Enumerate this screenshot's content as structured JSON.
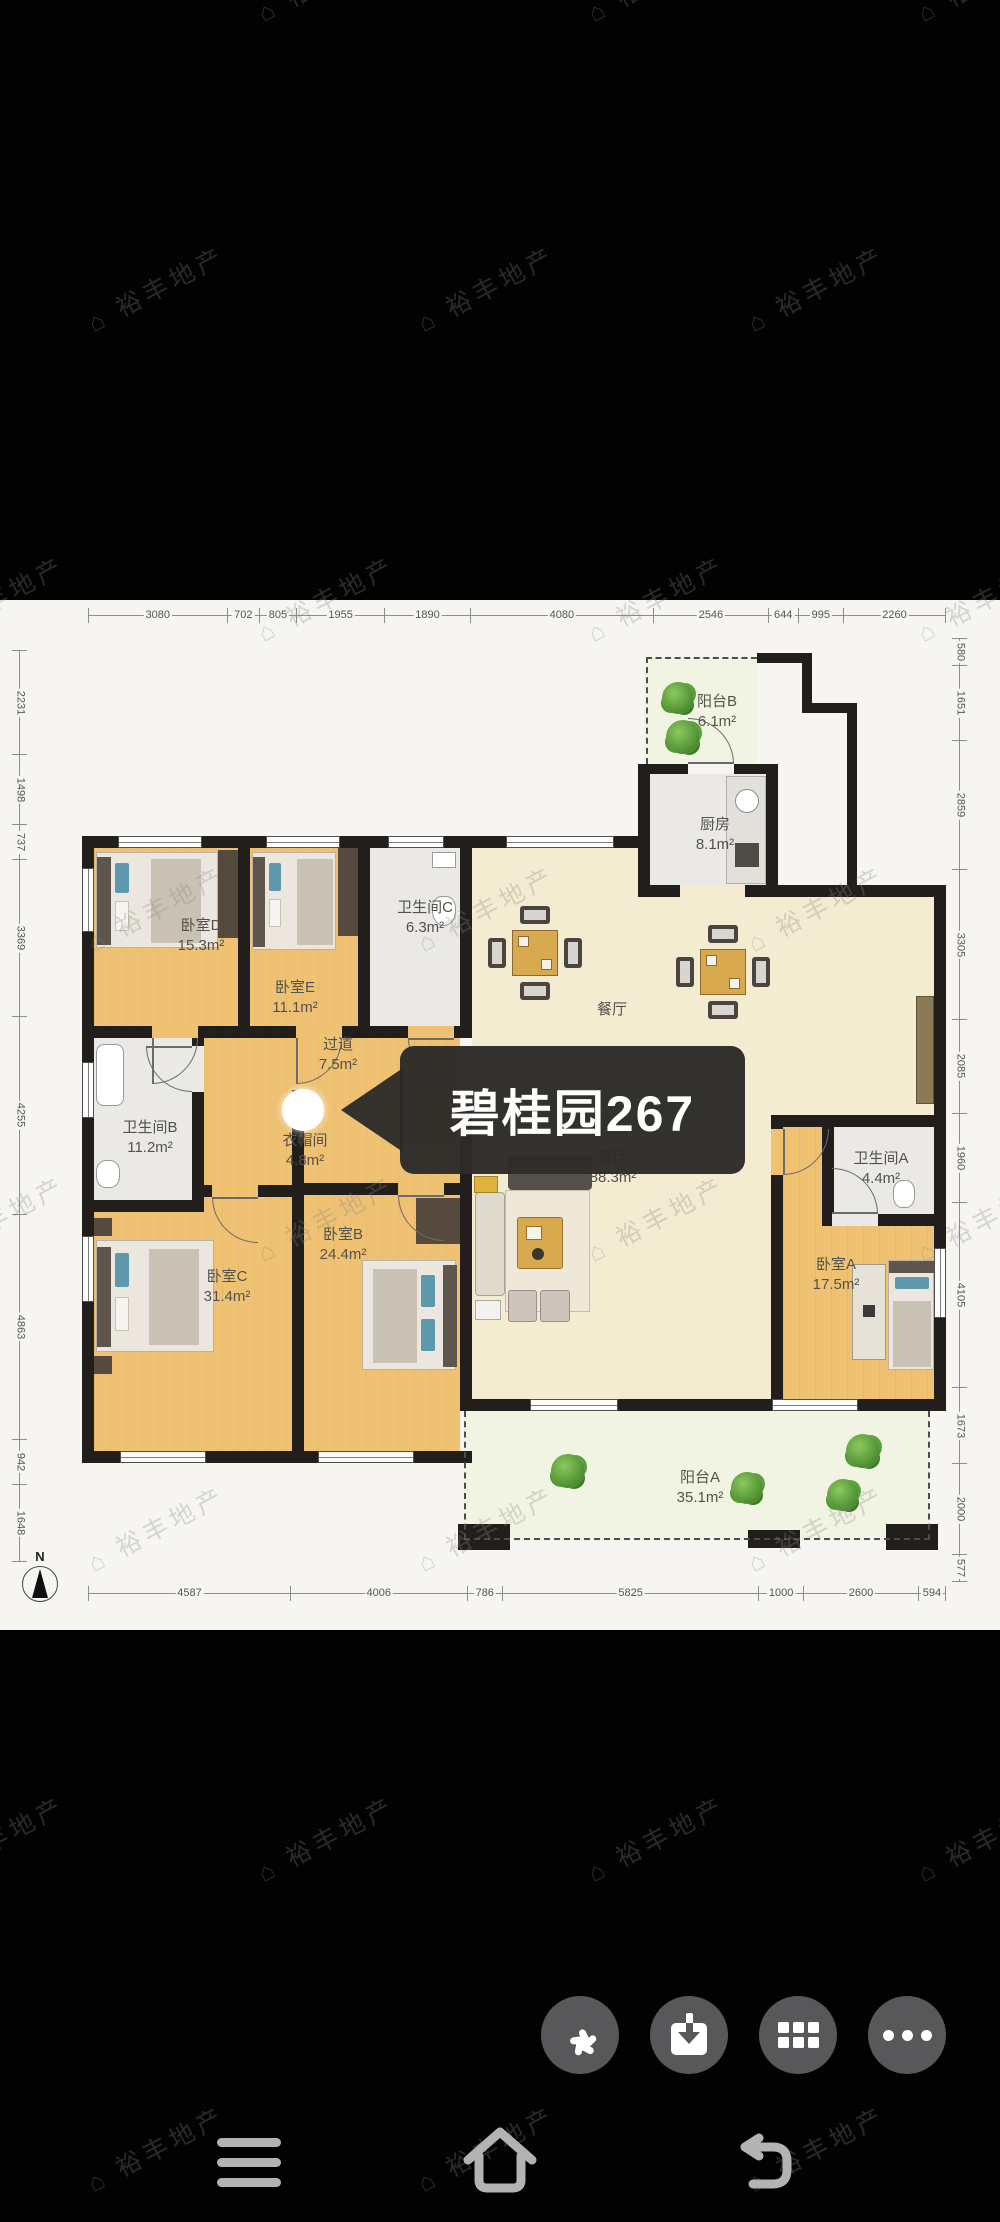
{
  "floorplan": {
    "overlay_title": "碧桂园267",
    "compass_label": "N",
    "rooms": {
      "bedroomD": {
        "name": "卧室D",
        "area": "15.3m²"
      },
      "bedroomE": {
        "name": "卧室E",
        "area": "11.1m²"
      },
      "bathC": {
        "name": "卫生间C",
        "area": "6.3m²"
      },
      "balconyB": {
        "name": "阳台B",
        "area": "6.1m²"
      },
      "kitchen": {
        "name": "厨房",
        "area": "8.1m²"
      },
      "dining": {
        "name": "餐厅"
      },
      "hallway": {
        "name": "过道",
        "area": "7.5m²"
      },
      "bathB": {
        "name": "卫生间B",
        "area": "11.2m²"
      },
      "cloakroom": {
        "name": "衣帽间",
        "area": "4.8m²"
      },
      "bedroomC": {
        "name": "卧室C",
        "area": "31.4m²"
      },
      "bedroomB": {
        "name": "卧室B",
        "area": "24.4m²"
      },
      "living": {
        "name": "客厅",
        "area": "88.3m²"
      },
      "bathA": {
        "name": "卫生间A",
        "area": "4.4m²"
      },
      "bedroomA": {
        "name": "卧室A",
        "area": "17.5m²"
      },
      "balconyA": {
        "name": "阳台A",
        "area": "35.1m²"
      }
    },
    "dimensions_mm": {
      "top": [
        3080,
        702,
        805,
        1955,
        1890,
        4080,
        2546,
        644,
        995,
        2260
      ],
      "bottom": [
        4587,
        4006,
        786,
        5825,
        1000,
        2600,
        594
      ],
      "left": [
        2231,
        1498,
        737,
        3369,
        4255,
        4863,
        942,
        1648
      ],
      "right": [
        580,
        1651,
        2859,
        3305,
        2085,
        1960,
        4105,
        1673,
        2000,
        577
      ]
    }
  },
  "watermark": {
    "logo": "⌂",
    "text": "裕丰地产"
  },
  "toolbar": {
    "buttons": [
      {
        "icon": "pinwheel-share-icon"
      },
      {
        "icon": "download-icon"
      },
      {
        "icon": "apps-grid-icon"
      },
      {
        "icon": "more-ellipsis-icon"
      }
    ]
  },
  "navbar": {
    "buttons": [
      {
        "icon": "menu-icon"
      },
      {
        "icon": "home-icon"
      },
      {
        "icon": "back-icon"
      }
    ]
  },
  "colors": {
    "pagebg": "#020202",
    "card": "#f6f5f1",
    "wall": "#211e1b",
    "tan": "#eec173",
    "cream": "#f4ecd0",
    "grayfloor": "#eae9e5",
    "balcony": "#f1f4e2",
    "banner": "#2d2b28",
    "teal": "#5d98ad",
    "plant": "#4a8c2e",
    "fab": "#58585a",
    "navicon": "#b3b3b3",
    "dimtext": "#555555"
  }
}
